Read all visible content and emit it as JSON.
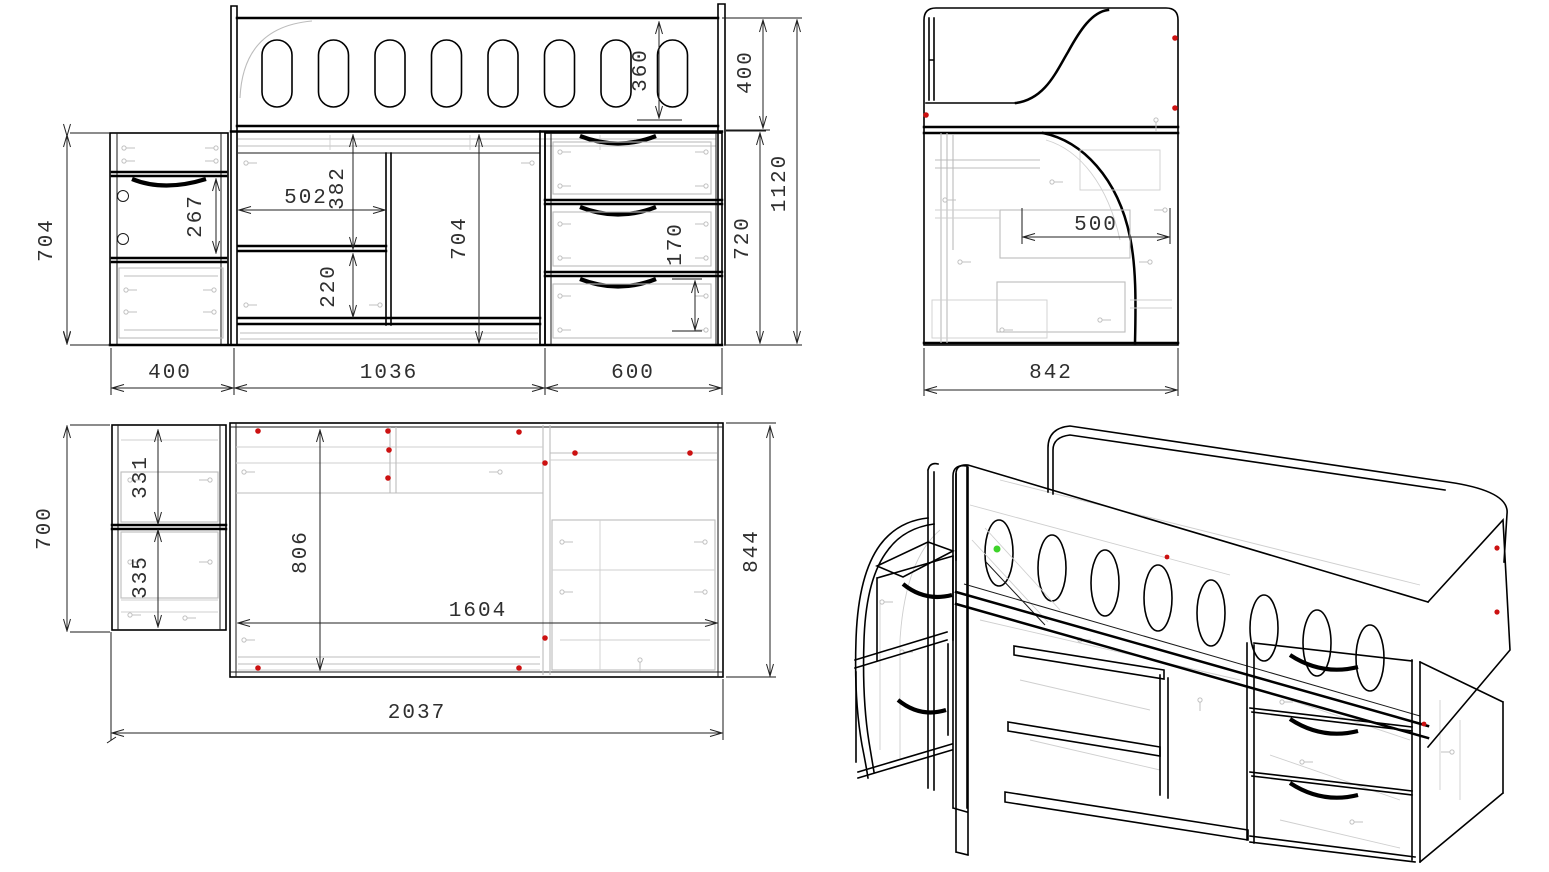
{
  "drawing": {
    "description": "Loft bed with desk, steps and drawer units - furniture assembly blueprint, four views",
    "front": {
      "rail_height": "360",
      "top_section": "400",
      "total_height": "1120",
      "lower_height": "720",
      "left_height": "704",
      "drawer_height": "267",
      "shelf_width": "502",
      "shelf_top_height": "382",
      "shelf_bottom_height": "220",
      "desk_opening_height": "704",
      "drawer_front_height": "170",
      "cabinet_width": "400",
      "desk_width": "1036",
      "drawers_width": "600"
    },
    "side": {
      "desk_depth": "500",
      "total_depth": "842"
    },
    "plan": {
      "cabinet_depth": "700",
      "step_depth_1": "331",
      "step_depth_2": "335",
      "bed_inner_width": "806",
      "bed_length": "1604",
      "total_depth": "844",
      "total_length": "2037"
    },
    "colors": {
      "line": "#000000",
      "hidden": "#bcbcbc",
      "marker_red": "#cc1111",
      "marker_green": "#3ed32a"
    }
  }
}
